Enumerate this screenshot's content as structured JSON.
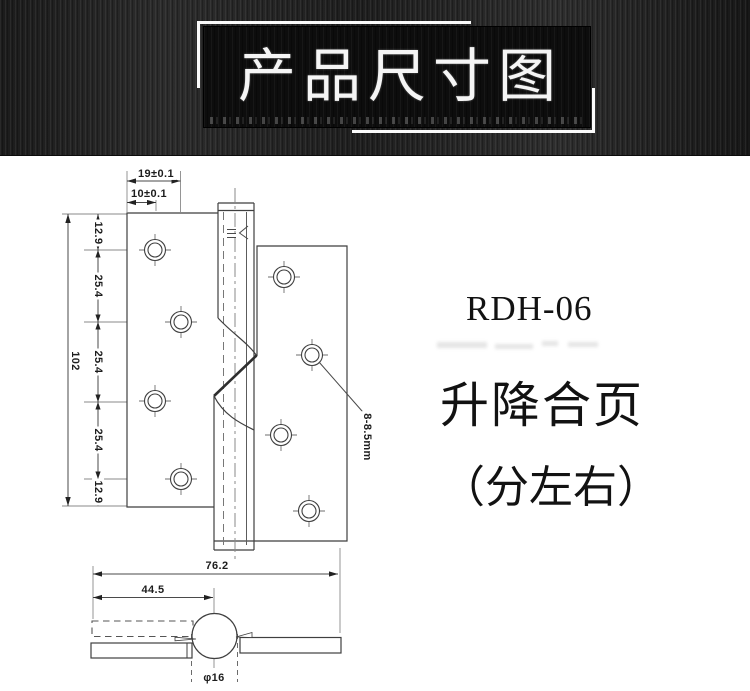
{
  "banner": {
    "title": "产品尺寸图"
  },
  "product": {
    "model": "RDH-06",
    "name": "升降合页",
    "note": "（分左右）"
  },
  "dims": {
    "top_outer": "19±0.1",
    "top_inner": "10±0.1",
    "chain": [
      "12.9",
      "25.4",
      "25.4",
      "25.4",
      "12.9"
    ],
    "total_height": "102",
    "hole_spec": "8-8.5mm",
    "bottom_width": "76.2",
    "pin_offset": "44.5",
    "knuckle_dia": "φ16"
  },
  "colors": {
    "outline": "#3f3f3f",
    "thin_line": "#888888",
    "banner_bg": "#0d0d0d",
    "banner_text": "#f5f5f5"
  }
}
